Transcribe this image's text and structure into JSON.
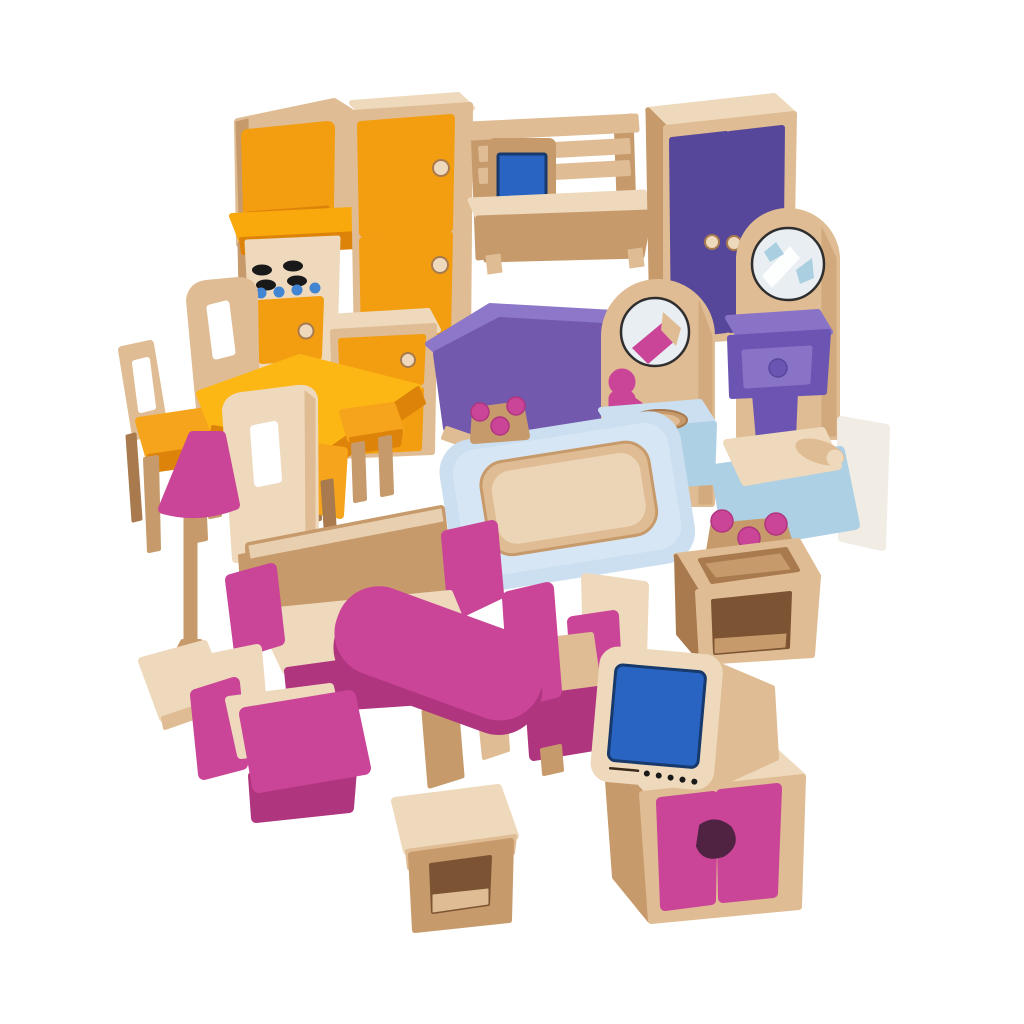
{
  "photo": {
    "subject": "wooden dollhouse furniture set",
    "background": "white",
    "items": [
      {
        "name": "kitchen-stove",
        "colors": [
          "orange",
          "wood"
        ],
        "details": [
          "microwave-block",
          "four-black-burners",
          "blue-knob-dots",
          "oven-door",
          "wood-knob"
        ]
      },
      {
        "name": "refrigerator",
        "colors": [
          "orange",
          "wood"
        ],
        "details": [
          "two-doors",
          "two-wood-knobs"
        ]
      },
      {
        "name": "desk-with-computer",
        "colors": [
          "wood",
          "blue"
        ],
        "details": [
          "rail-hutch",
          "blue-screen"
        ]
      },
      {
        "name": "wardrobe",
        "colors": [
          "purple",
          "wood"
        ],
        "details": [
          "double-doors",
          "two-wood-knobs"
        ]
      },
      {
        "name": "dressing-table",
        "colors": [
          "wood",
          "purple"
        ],
        "details": [
          "round-mirror",
          "drawer-with-knob",
          "pedestal"
        ]
      },
      {
        "name": "bathroom-sink-with-mirror",
        "colors": [
          "wood",
          "light-blue",
          "pink"
        ],
        "details": [
          "round-mirror",
          "pink-tap",
          "basin-hole",
          "pedestal"
        ]
      },
      {
        "name": "double-bed",
        "colors": [
          "purple",
          "wood"
        ],
        "details": [
          "wavy-headboard"
        ]
      },
      {
        "name": "bathtub",
        "colors": [
          "light-blue",
          "wood",
          "pink"
        ],
        "details": [
          "wood-basin",
          "pink-ball-taps"
        ]
      },
      {
        "name": "single-bed",
        "colors": [
          "light-blue",
          "wood"
        ],
        "details": [
          "wood-mattress",
          "bolster-pillow"
        ]
      },
      {
        "name": "washstand",
        "colors": [
          "wood",
          "pink"
        ],
        "details": [
          "three-pink-ball-taps",
          "basin-recess",
          "open-shelf"
        ]
      },
      {
        "name": "floor-lamp",
        "colors": [
          "pink",
          "wood"
        ],
        "details": [
          "cone-shade",
          "turned-base"
        ]
      },
      {
        "name": "dining-table",
        "colors": [
          "yellow",
          "wood"
        ]
      },
      {
        "name": "high-chair",
        "colors": [
          "wood",
          "orange"
        ],
        "details": [
          "slotted-back"
        ]
      },
      {
        "name": "side-chair-left",
        "colors": [
          "wood",
          "orange"
        ],
        "details": [
          "slotted-back",
          "orange-seat"
        ]
      },
      {
        "name": "side-chair-center",
        "colors": [
          "wood",
          "orange"
        ],
        "details": [
          "slotted-back",
          "orange-seat"
        ]
      },
      {
        "name": "kitchen-cabinet",
        "colors": [
          "wood",
          "orange"
        ],
        "details": [
          "drawer-with-knob",
          "door"
        ]
      },
      {
        "name": "kitchen-stool",
        "colors": [
          "wood",
          "orange"
        ]
      },
      {
        "name": "sofa",
        "colors": [
          "wood",
          "pink"
        ],
        "details": [
          "pink-arms"
        ]
      },
      {
        "name": "coffee-table",
        "colors": [
          "pink",
          "wood"
        ]
      },
      {
        "name": "armchair-left",
        "colors": [
          "wood",
          "pink"
        ]
      },
      {
        "name": "armchair-right",
        "colors": [
          "wood",
          "pink"
        ]
      },
      {
        "name": "television",
        "colors": [
          "wood",
          "blue"
        ],
        "details": [
          "blue-screen",
          "speaker-dots"
        ]
      },
      {
        "name": "tv-cabinet",
        "colors": [
          "wood",
          "magenta"
        ],
        "details": [
          "two-doors",
          "cutout-handle"
        ]
      },
      {
        "name": "side-table-stool",
        "colors": [
          "wood"
        ],
        "details": [
          "open-shelf"
        ]
      }
    ]
  },
  "palette": {
    "bg": "#ffffff",
    "wood-pale": "#eed9bc",
    "wood-light": "#dfbc93",
    "wood-mid": "#c79a6b",
    "wood-dark": "#a87a4e",
    "wood-deep": "#7c5434",
    "off-white": "#f1ece4",
    "orange": "#f39d10",
    "orange-bright": "#f9a90b",
    "orange-deep": "#dd830a",
    "yellow": "#fdb715",
    "seat-orange": "#f6a41b",
    "purple": "#57479b",
    "purple-mid": "#6c55b2",
    "purple-light": "#8973c7",
    "purple-bed": "#7259ae",
    "purple-bed-light": "#8d77c8",
    "magenta": "#ca4597",
    "magenta-dark": "#b0357f",
    "blue-screen": "#2a64c2",
    "blue-dot": "#4285d2",
    "blue-light": "#cbdff0",
    "blue-mid": "#aed0e4",
    "blue-ped": "#9cc3de",
    "mirror": "#e9eef2",
    "mirror-accent": "#a9cfe0",
    "black": "#191919",
    "white": "#ffffff",
    "cutout": "#512343"
  }
}
